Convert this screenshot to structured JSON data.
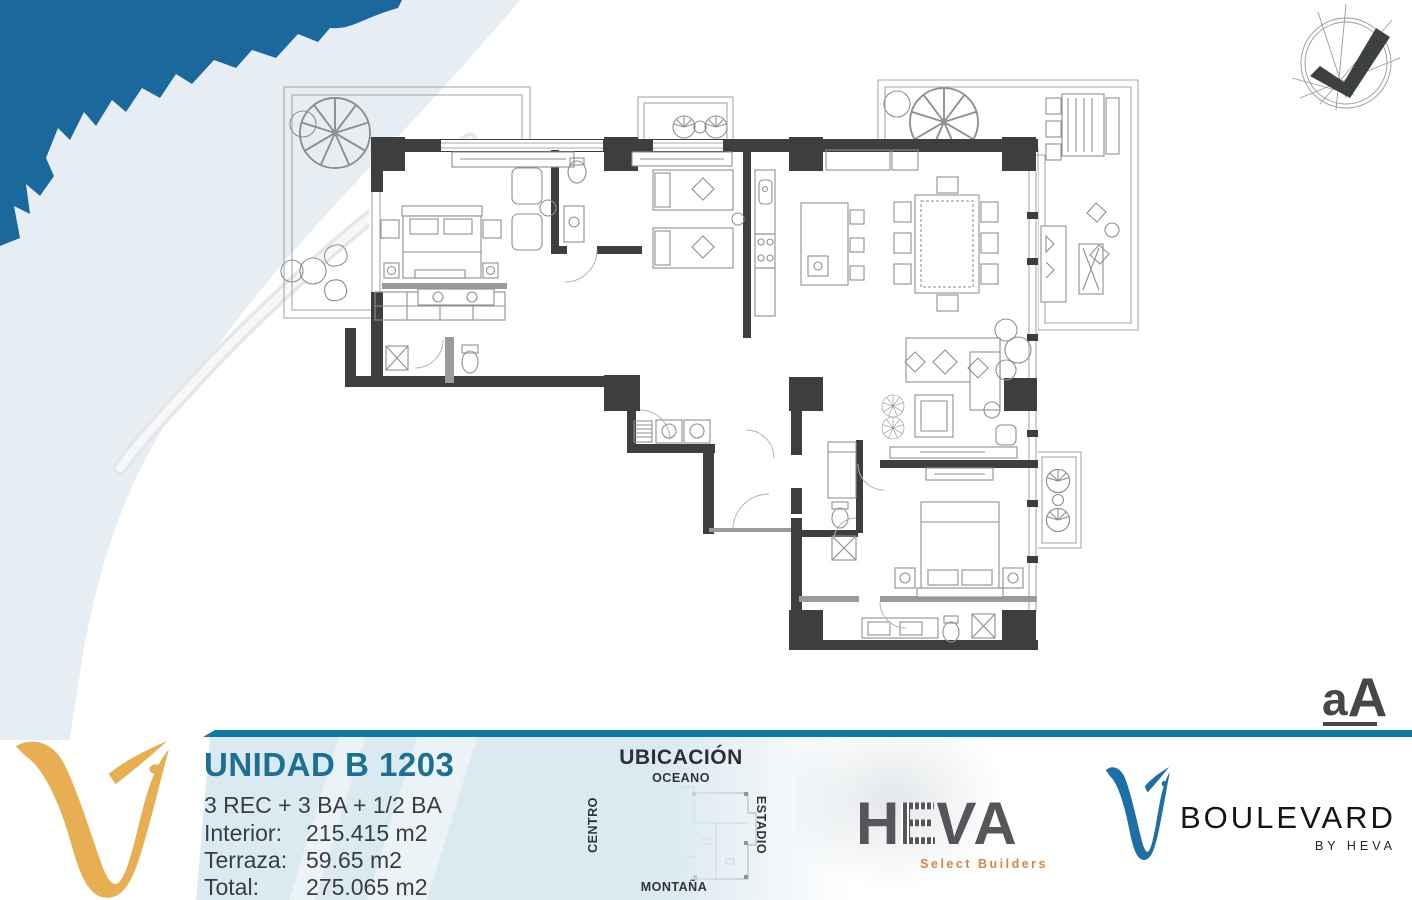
{
  "footer": {
    "unit": {
      "title": "UNIDAD B 1203",
      "config": "3 REC + 3 BA + 1/2 BA",
      "specs": [
        {
          "label": "Interior:",
          "value": "215.415 m2"
        },
        {
          "label": "Terraza:",
          "value": "59.65 m2"
        },
        {
          "label": "Total:",
          "value": "275.065 m2"
        }
      ]
    },
    "ubicacion": {
      "title": "UBICACIÓN",
      "north": "OCEANO",
      "south": "MONTAÑA",
      "west": "CENTRO",
      "east": "ESTADIO"
    },
    "heva": {
      "letters": [
        "H",
        "E",
        "V",
        "A"
      ],
      "tagline": "Select Builders"
    },
    "boulevard": {
      "name": "BOULEVARD",
      "byline": "BY HEVA"
    },
    "architect": {
      "a": "a",
      "cap": "A"
    }
  },
  "colors": {
    "teal_line": "#0d7aa3",
    "title_teal": "#1c7093",
    "panel_blue": "#dbe9f1",
    "gold_v": "#e8af52",
    "splash_blue": "#1b699c",
    "boulevard_blue": "#1e6fa5",
    "heva_gray": "#57555a",
    "heva_orange": "#df8140",
    "wall_gray": "#3e3e3e"
  }
}
